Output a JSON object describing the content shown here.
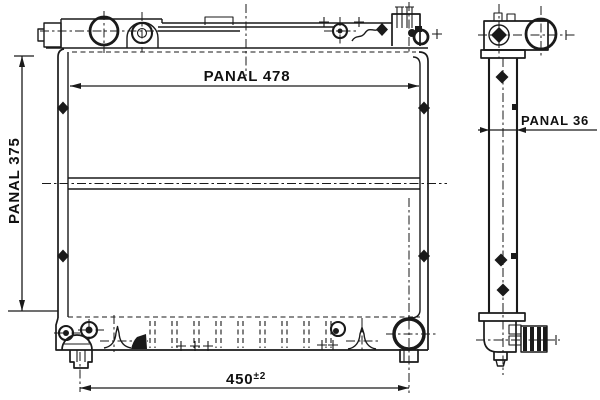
{
  "drawing": {
    "front_view": {
      "panel_width_label": "PANAL 478",
      "panel_height_label": "PANAL 375",
      "mount_span_value": "450",
      "mount_span_tolerance": "±2"
    },
    "side_view": {
      "panel_depth_label": "PANAL 36"
    },
    "colors": {
      "ink": "#1a1a1a",
      "paper": "#ffffff"
    }
  }
}
